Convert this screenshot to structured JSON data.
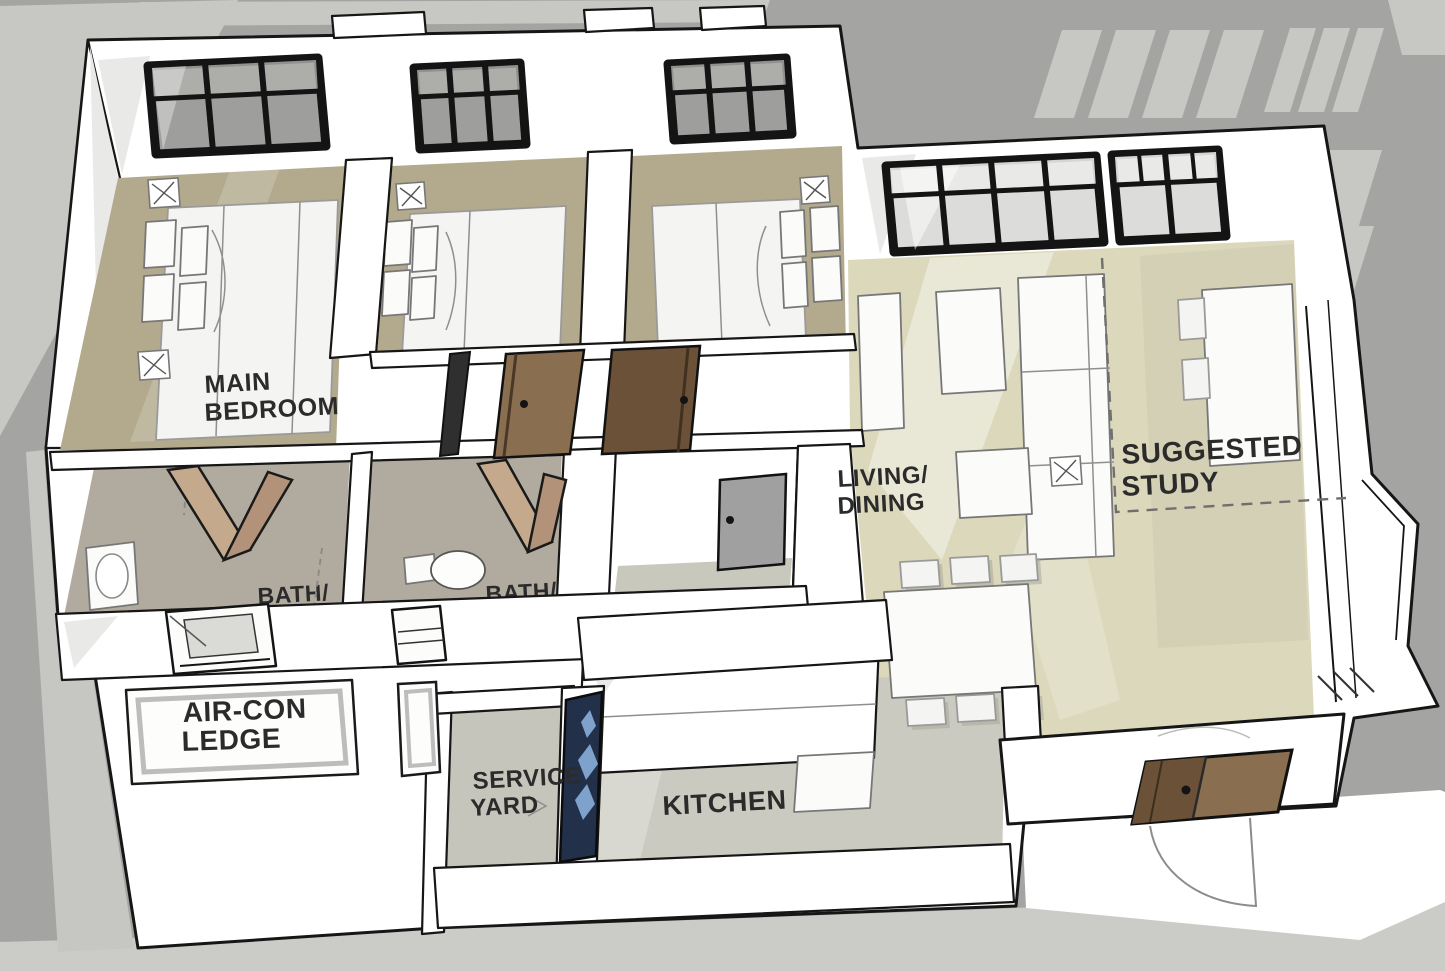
{
  "scene": {
    "description": "3D isometric cutaway floor plan of an apartment unit with three bedrooms, two baths, kitchen, service yard, living/dining area with suggested study corner and an external air-con ledge",
    "rooms_labeled": [
      "MAIN BEDROOM",
      "LIVING/DINING",
      "SUGGESTED STUDY",
      "BATH/",
      "BATH/",
      "AIR-CON LEDGE",
      "SERVICE YARD",
      "KITCHEN"
    ]
  },
  "labels": {
    "main_bedroom": [
      "MAIN",
      "BEDROOM"
    ],
    "living_dining": [
      "LIVING/",
      "DINING"
    ],
    "suggested_study": [
      "SUGGESTED",
      "STUDY"
    ],
    "bath_left": "BATH/",
    "bath_right": "BATH/",
    "aircon_ledge": [
      "AIR-CON",
      "LEDGE"
    ],
    "service_yard": [
      "SERVICE",
      "YARD"
    ],
    "kitchen": "KITCHEN"
  },
  "colors": {
    "background": "#a4a4a2",
    "light_panel": "#c7c7c4",
    "ground": "#cbcbc7",
    "wall_white": "#ffffff",
    "outline": "#161616",
    "floor_bedroom": "#b3aa8d",
    "floor_living": "#dcd8bb",
    "floor_bath": "#b1aa9e",
    "floor_store": "#c9c8bc",
    "floor_kitchen": "#cbcac0",
    "floor_service": "#c6c5bb",
    "door_brown": "#8a6e50",
    "door_brown_dark": "#6a5138",
    "door_fold_light": "#c5a98d",
    "door_fold_dark": "#b2937a",
    "door_gray": "#a0a0a0",
    "door_blue_frame": "#23304a",
    "glass_blue": "#7ea2cc",
    "glass_dark": "#9e9e9c",
    "glass_light": "#dcdcda",
    "label_ink": "#2b2b2b"
  }
}
